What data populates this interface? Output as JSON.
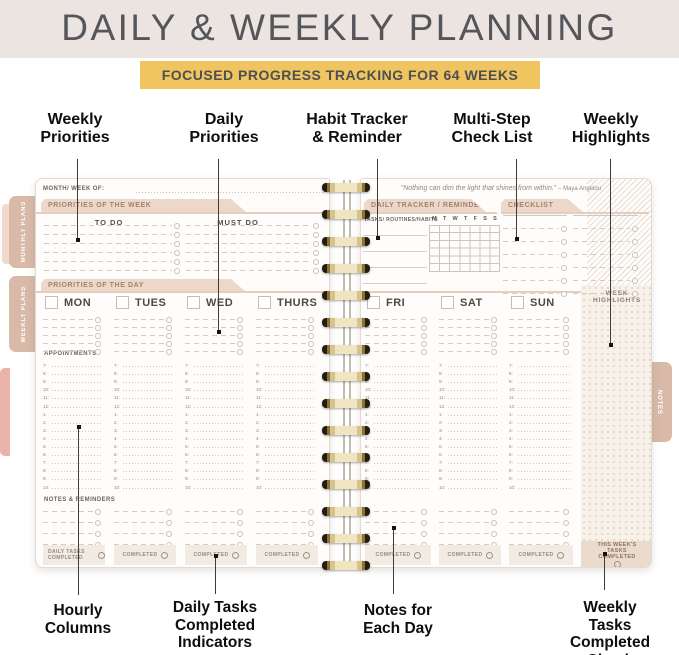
{
  "header": {
    "title": "DAILY & WEEKLY PLANNING",
    "ribbon": "FOCUSED PROGRESS TRACKING FOR 64 WEEKS"
  },
  "callouts": {
    "top": [
      {
        "label": "Weekly\nPriorities"
      },
      {
        "label": "Daily\nPriorities"
      },
      {
        "label": "Habit Tracker\n& Reminder"
      },
      {
        "label": "Multi-Step\nCheck List"
      },
      {
        "label": "Weekly\nHighlights"
      }
    ],
    "bottom": [
      {
        "label": "Hourly\nColumns"
      },
      {
        "label": "Daily Tasks\nCompleted\nIndicators"
      },
      {
        "label": "Notes for\nEach Day"
      },
      {
        "label": "Weekly Tasks\nCompleted\nCheck Box"
      }
    ]
  },
  "planner": {
    "left_page": {
      "month_week_label": "MONTH/ WEEK OF:",
      "priorities_week_header": "PRIORITIES OF THE WEEK",
      "todo_col": "TO DO",
      "mustdo_col": "MUST DO",
      "priorities_day_header": "PRIORITIES OF THE DAY",
      "days": [
        "MON",
        "TUES",
        "WED",
        "THURS"
      ],
      "appointments_label": "APPOINTMENTS",
      "hours": [
        "7:",
        "8:",
        "9:",
        "10:",
        "11:",
        "12:",
        "1:",
        "2:",
        "3:",
        "4:",
        "5:",
        "6:",
        "7:",
        "8:",
        "9:",
        "10:"
      ],
      "notes_label": "NOTES & REMINDERS",
      "daily_completed_label": "DAILY TASKS COMPLETED",
      "completed_label": "COMPLETED"
    },
    "right_page": {
      "quote": "“Nothing can dim the light that shines from within.”",
      "quote_author": "– Maya Angelou",
      "tracker_header": "DAILY TRACKER / REMINDER",
      "tasks_label": "TASKS/ ROUTINES/HABITS",
      "week_letters": [
        "M",
        "T",
        "W",
        "T",
        "F",
        "S",
        "S"
      ],
      "checklist_header": "CHECKLIST",
      "days": [
        "FRI",
        "SAT",
        "SUN"
      ],
      "completed_label": "COMPLETED",
      "week_highlights_label": "WEEK HIGHLIGHTS",
      "weekly_completed_label": "THIS WEEK’S TASKS COMPLETED"
    },
    "tabs": {
      "left": [
        "MONTHLY PLANS",
        "WEEKLY PLANS"
      ],
      "right": "NOTES"
    }
  },
  "colors": {
    "hero_bg": "#ebe4e0",
    "ribbon_bg": "#f0c55f",
    "title_text": "#54565b",
    "tab_header_bg": "#edd7c9",
    "tab_header_text": "#a08270",
    "rose_line": "#e6cdbe",
    "side_tab_bg": "#d9b9a7",
    "highlights_bg": "#f7f1ea",
    "weekly_box_bg": "#ebdbcc",
    "completed_box_bg": "#f2ebe3",
    "hatch": "#e7dcd2",
    "spiral_gold": "#d6c38b"
  }
}
